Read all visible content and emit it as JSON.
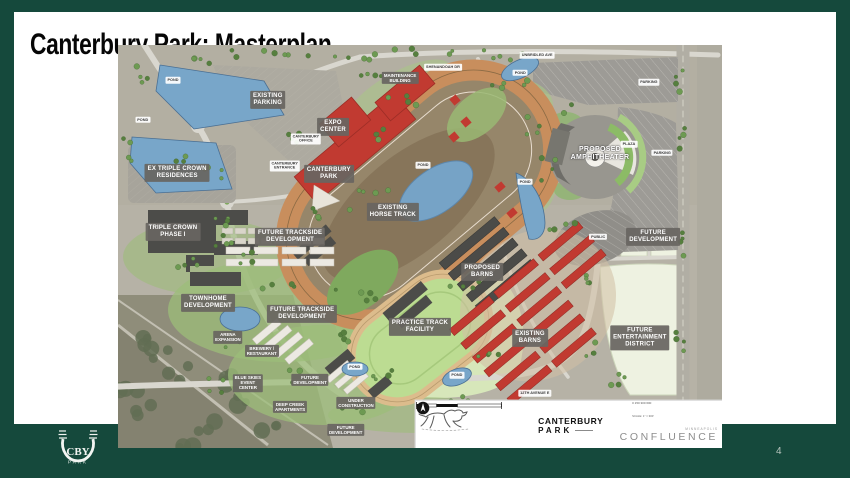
{
  "slide": {
    "title": "Canterbury Park: Masterplan",
    "page_number": "4"
  },
  "theme": {
    "border_green": "#15493c",
    "label_gray": "#686561",
    "existing_red": "#c13a31",
    "proposed_dark": "#4b4b48",
    "water_blue": "#78a6c9",
    "future_field": "#eef2e1"
  },
  "band_logo": {
    "monogram": "CBY",
    "word": "PARK"
  },
  "map": {
    "footer": {
      "brand_line1": "CANTERBURY",
      "brand_line2": "PARK",
      "firm_word": "CONFLUENCE",
      "firm_city": "MINNEAPOLIS",
      "scale_ticks": "0      150      300      600",
      "scale_note": "SCALE: 1\" = 300'"
    },
    "labels": [
      {
        "name": "label-existing-parking",
        "text": "EXISTING\nPARKING",
        "x": 24.8,
        "y": 13.6,
        "style": "dark"
      },
      {
        "name": "label-expo-center",
        "text": "EXPO\nCENTER",
        "x": 35.6,
        "y": 20.3,
        "style": "dark"
      },
      {
        "name": "label-canterbury-park",
        "text": "CANTERBURY\nPARK",
        "x": 34.9,
        "y": 32.0,
        "style": "dark"
      },
      {
        "name": "label-existing-horse-track",
        "text": "EXISTING\nHORSE TRACK",
        "x": 45.5,
        "y": 41.4,
        "style": "dark"
      },
      {
        "name": "label-ex-triple-crown-residences",
        "text": "EX TRIPLE CROWN\nRESIDENCES",
        "x": 9.8,
        "y": 31.8,
        "style": "dark"
      },
      {
        "name": "label-triple-crown-phase-1",
        "text": "TRIPLE CROWN\nPHASE I",
        "x": 9.1,
        "y": 46.4,
        "style": "dark"
      },
      {
        "name": "label-future-trackside-development-north",
        "text": "FUTURE TRACKSIDE\nDEVELOPMENT",
        "x": 28.5,
        "y": 47.6,
        "style": "dark"
      },
      {
        "name": "label-townhome-development",
        "text": "TOWNHOME\nDEVELOPMENT",
        "x": 14.9,
        "y": 64.0,
        "style": "dark"
      },
      {
        "name": "label-future-trackside-development-south",
        "text": "FUTURE TRACKSIDE\nDEVELOPMENT",
        "x": 30.5,
        "y": 66.7,
        "style": "dark"
      },
      {
        "name": "label-proposed-barns",
        "text": "PROPOSED\nBARNS",
        "x": 60.3,
        "y": 56.3,
        "style": "dark"
      },
      {
        "name": "label-existing-barns",
        "text": "EXISTING\nBARNS",
        "x": 68.2,
        "y": 72.7,
        "style": "dark"
      },
      {
        "name": "label-practice-track-facility",
        "text": "PRACTICE TRACK\nFACILITY",
        "x": 50.0,
        "y": 70.0,
        "style": "dark"
      },
      {
        "name": "label-future-development-east",
        "text": "FUTURE\nDEVELOPMENT",
        "x": 88.6,
        "y": 47.6,
        "style": "dark"
      },
      {
        "name": "label-future-entertainment-district",
        "text": "FUTURE\nENTERTAINMENT\nDISTRICT",
        "x": 86.4,
        "y": 72.7,
        "style": "dark"
      },
      {
        "name": "label-proposed-amphitheater",
        "text": "PROPOSED\nAMPHITHEATER",
        "x": 79.8,
        "y": 27.0,
        "style": "plain"
      },
      {
        "name": "label-maintenance-building",
        "text": "MAINTENANCE\nBUILDING",
        "x": 46.7,
        "y": 8.2,
        "style": "darksm"
      },
      {
        "name": "label-arena-expansion",
        "text": "ARENA\nEXPANSION",
        "x": 18.2,
        "y": 72.5,
        "style": "darksm"
      },
      {
        "name": "label-brewery-restaurant",
        "text": "BREWERY /\nRESTAURANT",
        "x": 23.8,
        "y": 75.9,
        "style": "darksm"
      },
      {
        "name": "label-blue-skies-event-center",
        "text": "BLUE SKIES\nEVENT\nCENTER",
        "x": 21.5,
        "y": 83.9,
        "style": "darksm"
      },
      {
        "name": "label-future-development-mid",
        "text": "FUTURE\nDEVELOPMENT",
        "x": 31.8,
        "y": 83.1,
        "style": "darksm"
      },
      {
        "name": "label-deep-creek-apartments",
        "text": "DEEP CREEK\nAPARTMENTS",
        "x": 28.5,
        "y": 89.8,
        "style": "darksm"
      },
      {
        "name": "label-under-construction",
        "text": "UNDER\nCONSTRUCTION",
        "x": 39.4,
        "y": 88.8,
        "style": "darksm"
      },
      {
        "name": "label-future-development-south",
        "text": "FUTURE\nDEVELOPMENT",
        "x": 37.7,
        "y": 95.5,
        "style": "darksm"
      },
      {
        "name": "label-pond-1",
        "text": "POND",
        "x": 9.1,
        "y": 8.7,
        "style": "white"
      },
      {
        "name": "label-pond-2",
        "text": "POND",
        "x": 4.1,
        "y": 18.6,
        "style": "white"
      },
      {
        "name": "label-pond-infield",
        "text": "POND",
        "x": 50.5,
        "y": 29.8,
        "style": "white"
      },
      {
        "name": "label-pond-north",
        "text": "POND",
        "x": 66.6,
        "y": 6.9,
        "style": "white"
      },
      {
        "name": "label-pond-east",
        "text": "POND",
        "x": 67.4,
        "y": 34.0,
        "style": "white"
      },
      {
        "name": "label-pond-southwest",
        "text": "POND",
        "x": 39.2,
        "y": 79.9,
        "style": "white"
      },
      {
        "name": "label-pond-southeast",
        "text": "POND",
        "x": 56.1,
        "y": 81.9,
        "style": "white"
      },
      {
        "name": "label-plaza",
        "text": "PLAZA",
        "x": 84.6,
        "y": 24.6,
        "style": "white"
      },
      {
        "name": "label-parking-north",
        "text": "PARKING",
        "x": 87.9,
        "y": 9.2,
        "style": "white"
      },
      {
        "name": "label-parking-east",
        "text": "PARKING",
        "x": 90.1,
        "y": 26.8,
        "style": "white"
      },
      {
        "name": "label-public-lot",
        "text": "PUBLIC",
        "x": 79.5,
        "y": 47.6,
        "style": "white"
      },
      {
        "name": "label-unbridled-ave",
        "text": "UNBRIDLED AVE",
        "x": 69.4,
        "y": 2.5,
        "style": "white"
      },
      {
        "name": "label-shenandoah-dr",
        "text": "SHENANDOAH DR",
        "x": 53.8,
        "y": 5.5,
        "style": "white"
      },
      {
        "name": "label-12th-avenue",
        "text": "12TH AVENUE E",
        "x": 69.0,
        "y": 86.4,
        "style": "white"
      },
      {
        "name": "label-canterbury-office",
        "text": "CANTERBURY\nOFFICE",
        "x": 31.1,
        "y": 23.3,
        "style": "white"
      },
      {
        "name": "label-canterbury-entrance",
        "text": "CANTERBURY\nENTRANCE",
        "x": 27.6,
        "y": 30.0,
        "style": "white"
      }
    ]
  }
}
